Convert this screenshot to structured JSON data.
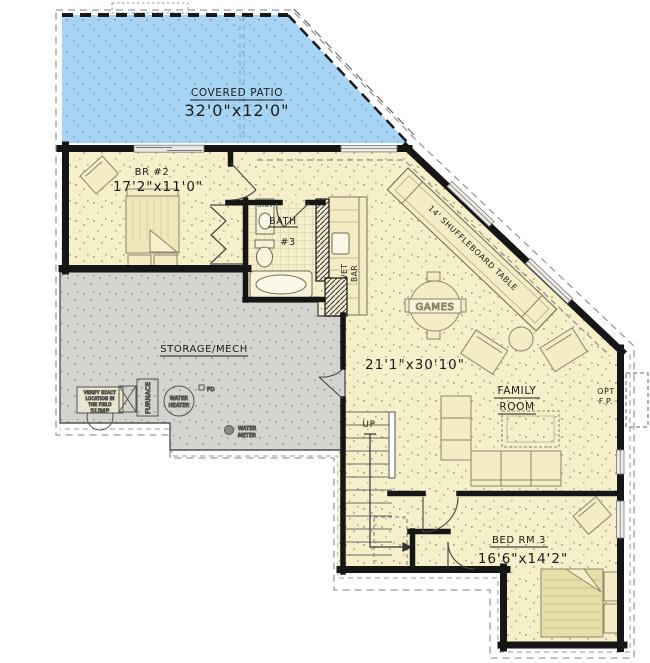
{
  "patio": {
    "label": "COVERED PATIO",
    "dims": "32'0\"x12'0\""
  },
  "rooms": {
    "br2": {
      "label": "BR #2",
      "dims": "17'2\"x11'0\""
    },
    "bath": {
      "label": "BATH",
      "number": "#3",
      "drawers": "DRWS"
    },
    "wet_bar": {
      "word1": "WET",
      "word2": "BAR"
    },
    "storage": {
      "label": "STORAGE/MECH"
    },
    "family": {
      "dims": "21'1\"x30'10\"",
      "label1": "FAMILY",
      "label2": "ROOM",
      "games": "GAMES",
      "shuffleboard": "14' SHUFFLEBOARD TABLE",
      "opt1": "OPT",
      "opt2": "F.P."
    },
    "bed3": {
      "label": "BED RM 3",
      "dims": "16'6\"x14'2\""
    },
    "stairs": {
      "up": "UP"
    }
  },
  "equipment": {
    "sump": {
      "note1": "VERIFY EXACT",
      "note2": "LOCATION IN",
      "note3": "THE FIELD",
      "label": "SUMP"
    },
    "furnace": "FURNACE",
    "water_heater": {
      "l1": "WATER",
      "l2": "HEATER"
    },
    "floor_drain": "FD",
    "water_meter": {
      "l1": "WATER",
      "l2": "METER"
    }
  },
  "colors": {
    "patio": "#a6d4f2",
    "floor": "#f6f0ca",
    "storage": "#d4d3cf",
    "wall": "#161616"
  }
}
